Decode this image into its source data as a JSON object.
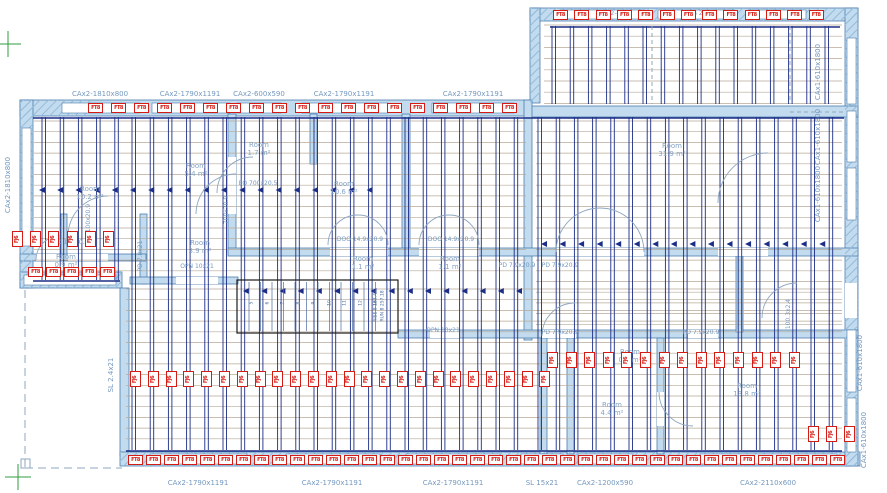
{
  "drawing": {
    "room_word": "Room",
    "colors": {
      "label_blue": "#7498bf",
      "room_blue": "#86a4c5",
      "wall_fill": "#c2dbee",
      "wall_stroke": "#4d7dad",
      "hatch": "#93bcdc",
      "joist_navy": "#1b2d85",
      "grid_tan": "#b7a996",
      "marker_red": "#d41c14",
      "survey_green": "#2f9e3f",
      "dash_blue": "#8fa9c2",
      "arc_blue": "#8fa6c0",
      "stair_black": "#1c1c1c",
      "number_blue": "#4a6aa0"
    },
    "window_labels": [
      {
        "t": "CAx2-1810x800",
        "x": 100,
        "y": 94
      },
      {
        "t": "CAx2-1790x1191",
        "x": 190,
        "y": 94
      },
      {
        "t": "CAx2-600x590",
        "x": 259,
        "y": 94
      },
      {
        "t": "CAx2-1790x1191",
        "x": 344,
        "y": 94
      },
      {
        "t": "CAx2-1790x1191",
        "x": 473,
        "y": 94
      },
      {
        "t": "CAx2-1790x1191",
        "x": 198,
        "y": 483
      },
      {
        "t": "CAx2-1790x1191",
        "x": 332,
        "y": 483
      },
      {
        "t": "CAx2-1790x1191",
        "x": 453,
        "y": 483
      },
      {
        "t": "SL 15x21",
        "x": 542,
        "y": 483
      },
      {
        "t": "CAx2-1200x590",
        "x": 605,
        "y": 483
      },
      {
        "t": "CAx2-2110x600",
        "x": 768,
        "y": 483
      },
      {
        "t": "CAx2-1810x800",
        "x": 8,
        "y": 185,
        "rot": true
      },
      {
        "t": "SL 2.4x21",
        "x": 111,
        "y": 375,
        "rot": true
      },
      {
        "t": "CAx1-610x1800",
        "x": 818,
        "y": 72,
        "rot": true
      },
      {
        "t": "CAx1-610x1800",
        "x": 818,
        "y": 137,
        "rot": true
      },
      {
        "t": "CAx1-610x1800",
        "x": 818,
        "y": 194,
        "rot": true
      },
      {
        "t": "CAx1-610x1800",
        "x": 860,
        "y": 363,
        "rot": true
      },
      {
        "t": "CAx1-610x1800",
        "x": 864,
        "y": 440,
        "rot": true
      }
    ],
    "door_labels": [
      {
        "t": "EO 700x20.5",
        "x": 258,
        "y": 184
      },
      {
        "t": "DOO 14x20.5",
        "x": 68,
        "y": 243
      },
      {
        "t": "DOO 14.9x20.9",
        "x": 360,
        "y": 240
      },
      {
        "t": "DOO 14.9x20.9",
        "x": 451,
        "y": 240
      },
      {
        "t": "PD 7.9x20.9",
        "x": 517,
        "y": 266
      },
      {
        "t": "PD 7.9x20.9",
        "x": 560,
        "y": 266
      },
      {
        "t": "OPN 10x21",
        "x": 197,
        "y": 267
      },
      {
        "t": "OPN 10x21",
        "x": 443,
        "y": 331
      },
      {
        "t": "PD 7.9x20.9",
        "x": 560,
        "y": 333
      },
      {
        "t": "PD 7.9x20.9",
        "x": 701,
        "y": 333
      },
      {
        "t": "PD 7.8x21",
        "x": 141,
        "y": 256,
        "rot": true
      },
      {
        "t": "700x20.9",
        "x": 227,
        "y": 210,
        "rot": true
      },
      {
        "t": "1100x20.9",
        "x": 89,
        "y": 220,
        "rot": true
      },
      {
        "t": "100.3x2.4",
        "x": 789,
        "y": 314,
        "rot": true
      }
    ],
    "note_labels": [
      {
        "t": "VB2 2-4x8",
        "x": 612,
        "y": 14
      },
      {
        "t": "G 2x8 4",
        "x": 704,
        "y": 14
      }
    ],
    "room_labels": [
      {
        "a": "5.4 m²",
        "x": 196,
        "y": 170
      },
      {
        "a": "1.7 m²",
        "x": 259,
        "y": 149
      },
      {
        "a": "10.2 m²",
        "x": 90,
        "y": 193
      },
      {
        "a": "10.6 m²",
        "x": 344,
        "y": 188
      },
      {
        "a": "31.9 m²",
        "x": 672,
        "y": 150
      },
      {
        "a": "3.9 m²",
        "x": 200,
        "y": 247
      },
      {
        "a": "1.1 m²",
        "x": 363,
        "y": 263
      },
      {
        "a": "1.1 m²",
        "x": 450,
        "y": 263
      },
      {
        "a": "0.9 m²",
        "x": 66,
        "y": 261
      },
      {
        "a": "0.9 m²",
        "x": 630,
        "y": 356
      },
      {
        "a": "4.4 m²",
        "x": 612,
        "y": 409
      },
      {
        "a": "13.8 m²",
        "x": 747,
        "y": 390
      }
    ],
    "stairs": {
      "notes": [
        {
          "t": "RISE 8 163.47",
          "x": 376,
          "y": 306
        },
        {
          "t": "RUN 8 257.18",
          "x": 383,
          "y": 306
        }
      ],
      "numbers": [
        "5",
        "6",
        "7",
        "8",
        "9",
        "10",
        "11",
        "12",
        "13"
      ],
      "numbers_x0": 252,
      "numbers_pitch": 15.5,
      "numbers_y": 303
    },
    "markers": {
      "ft8": {
        "label": "FT8",
        "rows": [
          {
            "y": 103,
            "x0": 88,
            "pitch": 23,
            "count": 19
          },
          {
            "y": 10,
            "x0": 553,
            "pitch": 21.3,
            "count": 13
          },
          {
            "y": 455,
            "x0": 128,
            "pitch": 18,
            "count": 40
          },
          {
            "y": 267,
            "x0": 28,
            "pitch": 18,
            "count": 5
          }
        ]
      },
      "fj": {
        "label": "FJ6",
        "rows": [
          {
            "y": 231,
            "x0": 12,
            "pitch": 18.2,
            "count": 6
          },
          {
            "y": 371,
            "x0": 130,
            "pitch": 17.8,
            "count": 24
          },
          {
            "y": 352,
            "x0": 547,
            "pitch": 18.6,
            "count": 14
          },
          {
            "y": 426,
            "x0": 808,
            "pitch": 18,
            "count": 3
          }
        ]
      }
    }
  }
}
